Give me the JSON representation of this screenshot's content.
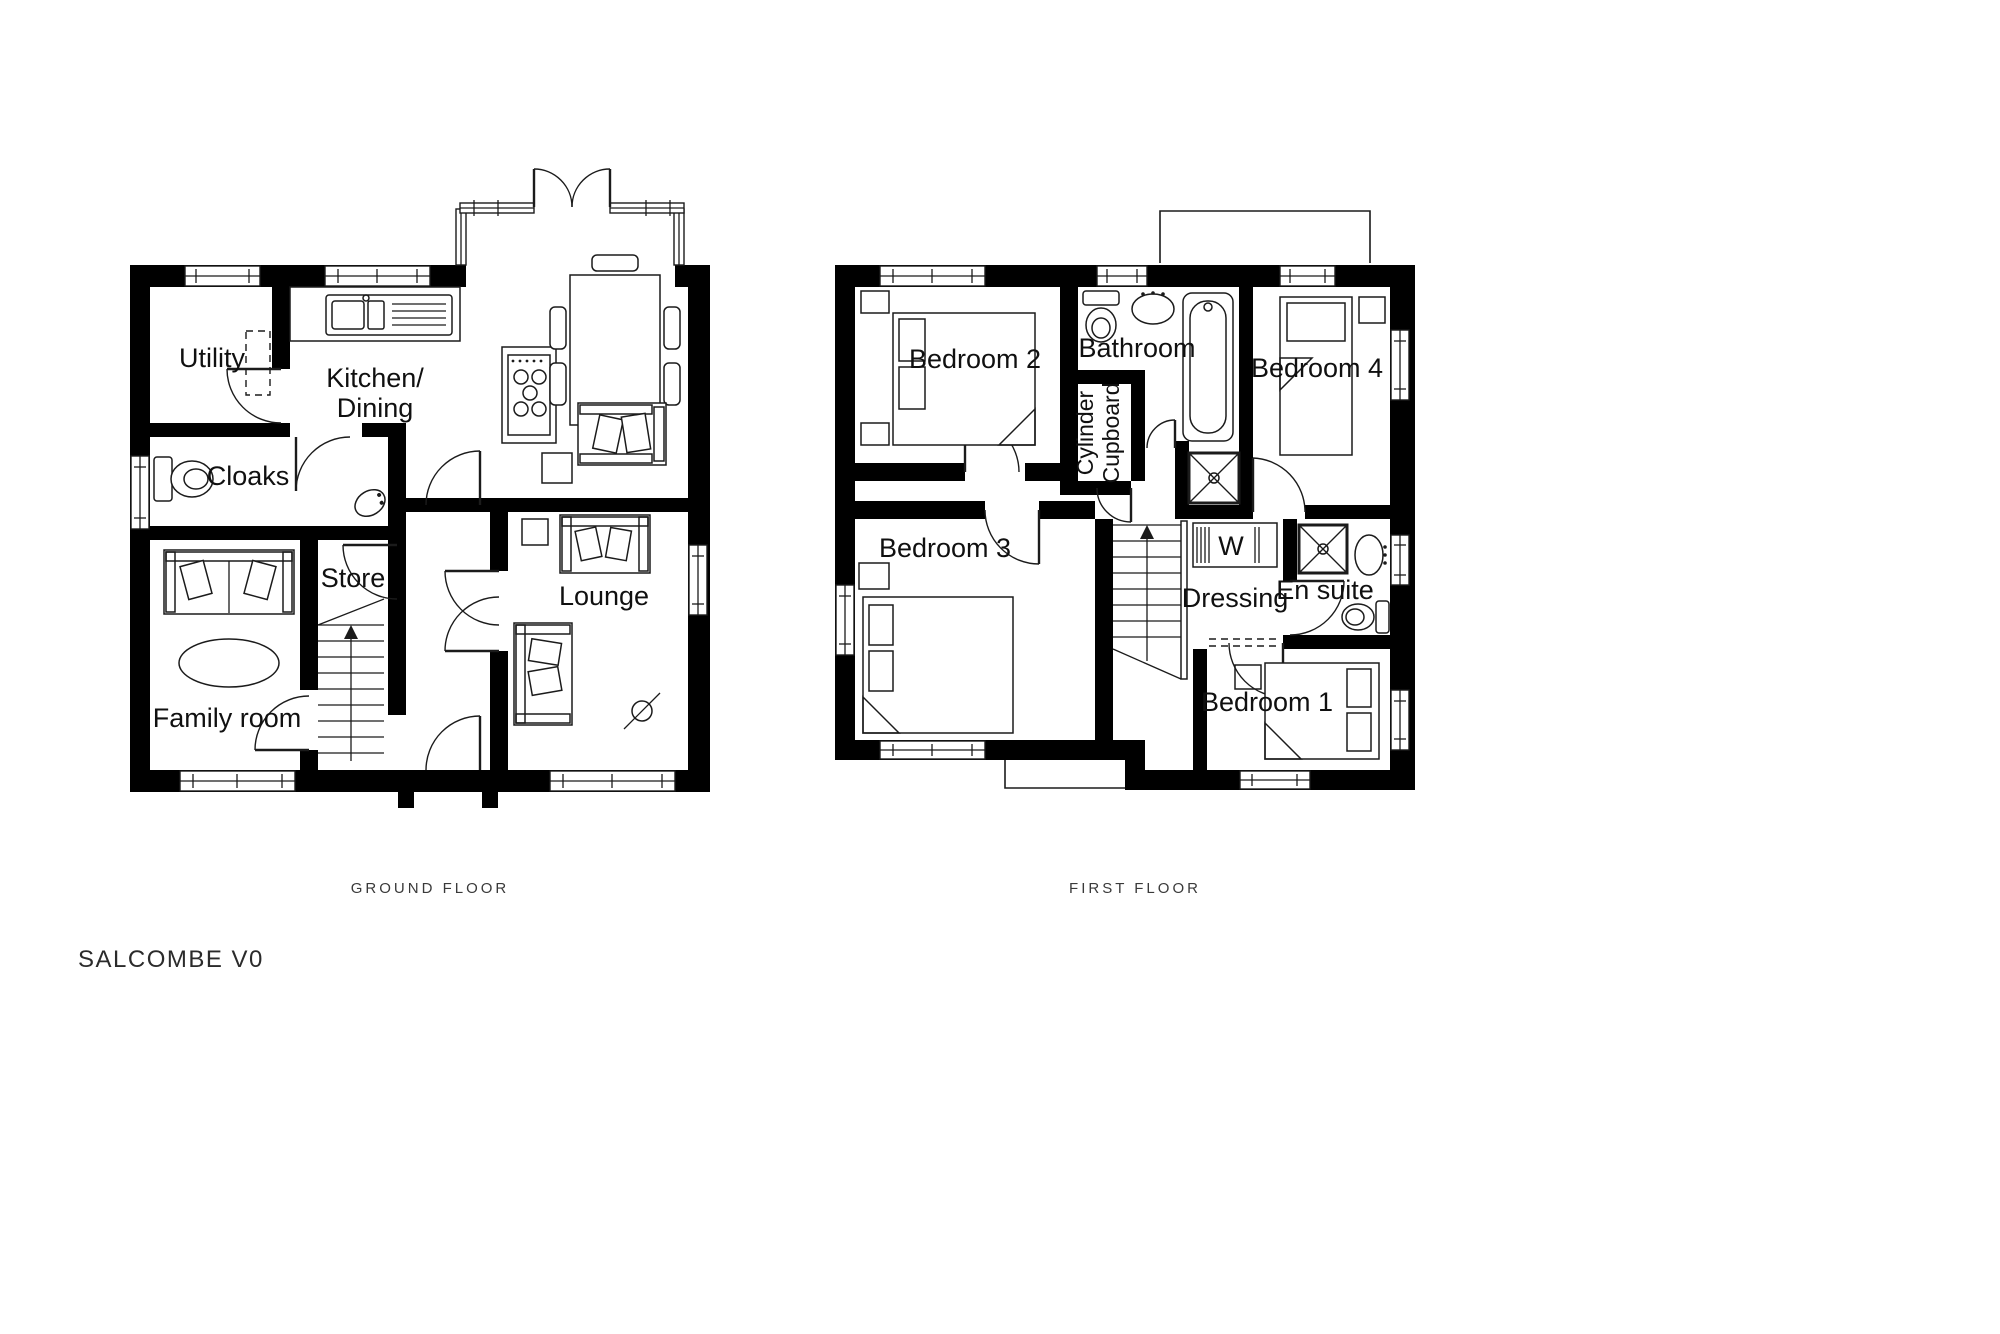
{
  "title": "SALCOMBE V0",
  "ground": {
    "caption": "GROUND FLOOR",
    "rooms": {
      "utility": "Utility",
      "cloaks": "Cloaks",
      "kitchen1": "Kitchen/",
      "kitchen2": "Dining",
      "store": "Store",
      "family": "Family room",
      "lounge": "Lounge"
    }
  },
  "first": {
    "caption": "FIRST FLOOR",
    "rooms": {
      "bedroom2": "Bedroom 2",
      "bathroom": "Bathroom",
      "bedroom4": "Bedroom 4",
      "cylinder1": "Cylinder",
      "cylinder2": "Cupboard",
      "bedroom3": "Bedroom 3",
      "wardrobe": "W",
      "dressing": "Dressing",
      "ensuite": "En suite",
      "bedroom1": "Bedroom 1"
    }
  },
  "colors": {
    "wall": "#000000",
    "text": "#101010",
    "background": "#ffffff"
  }
}
